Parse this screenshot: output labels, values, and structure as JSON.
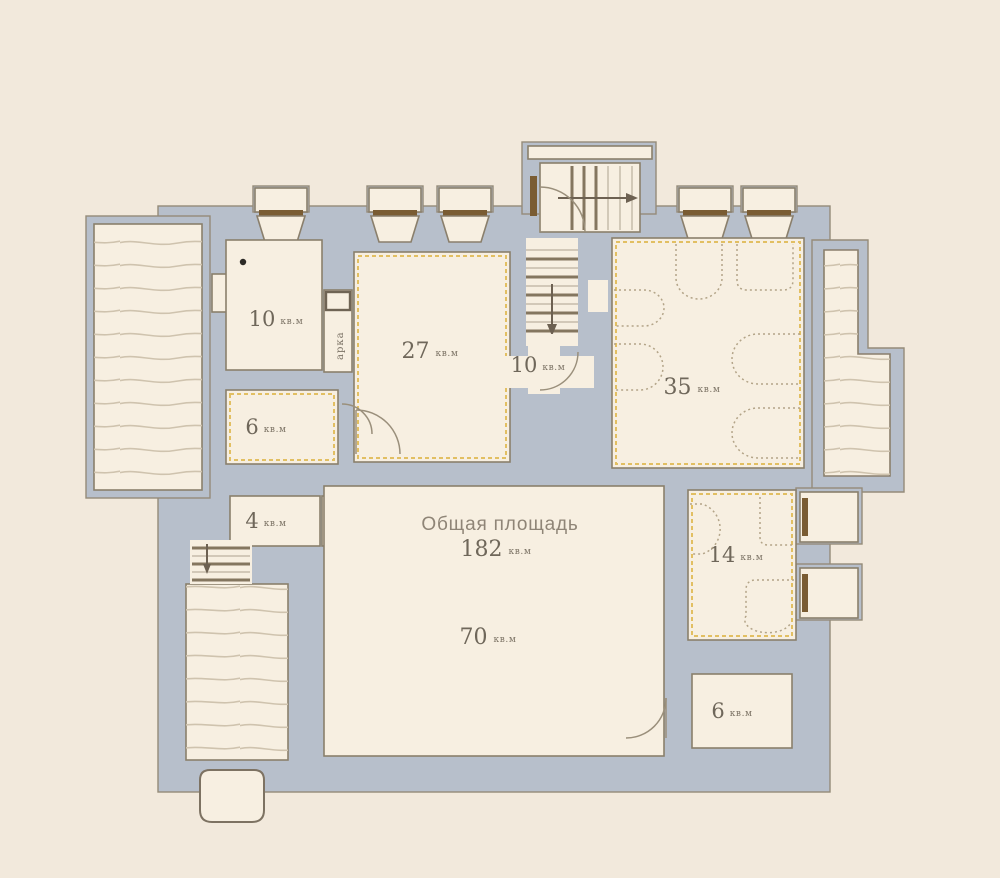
{
  "plan_title": {
    "label": "Общая площадь",
    "value": "182",
    "unit": "кв.м"
  },
  "rooms": [
    {
      "name": "room-top-left",
      "area": "10",
      "unit": "кв.м"
    },
    {
      "name": "room-27",
      "area": "27",
      "unit": "кв.м"
    },
    {
      "name": "hall-middle",
      "area": "10",
      "unit": "кв.м"
    },
    {
      "name": "room-35",
      "area": "35",
      "unit": "кв.м"
    },
    {
      "name": "room-6-left",
      "area": "6",
      "unit": "кв.м"
    },
    {
      "name": "room-4",
      "area": "4",
      "unit": "кв.м"
    },
    {
      "name": "room-70",
      "area": "70",
      "unit": "кв.м"
    },
    {
      "name": "room-14",
      "area": "14",
      "unit": "кв.м"
    },
    {
      "name": "room-6-bottom-right",
      "area": "6",
      "unit": "кв.м"
    }
  ],
  "annotations": {
    "arch": "арка"
  },
  "colors": {
    "background": "#f2e9dc",
    "wall": "#b7bfcb",
    "room": "#f7efe1",
    "outline": "#8a7f6c",
    "accent_dashed": "#e2bf62",
    "window_frame": "#7a5c33",
    "hatch_line": "#cfc3ae"
  }
}
